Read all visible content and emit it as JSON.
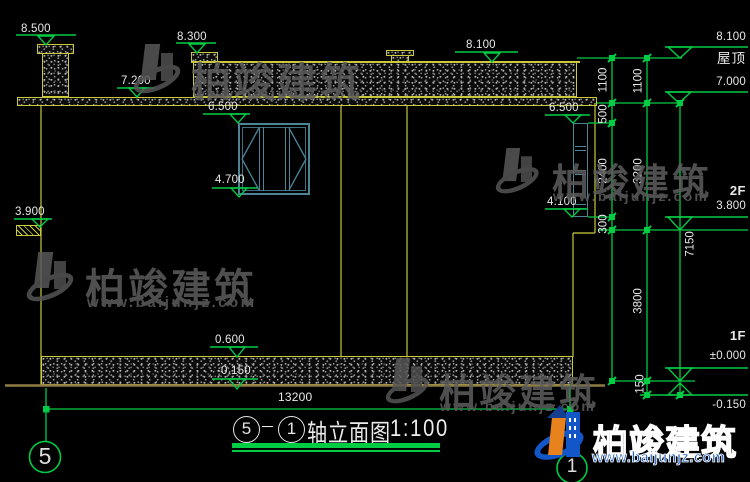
{
  "title_block": {
    "axis_from": "5",
    "axis_to": "1",
    "dash": "－",
    "name": "轴立面图",
    "scale": "1:100"
  },
  "levels": {
    "v8500": "8.500",
    "v8300": "8.300",
    "v8100": "8.100",
    "v7200": "7.200",
    "v7000": "7.000",
    "v6500": "6.500",
    "v4700": "4.700",
    "v4100": "4.100",
    "v3900": "3.900",
    "v3800": "3.800",
    "v0600": "0.600",
    "v0000": "±0.000",
    "vm0150": "-0.150"
  },
  "dimensions": {
    "d1100": "1100",
    "d500": "500",
    "d2400": "2400",
    "d300": "300",
    "d3200": "3200",
    "d3800": "3800",
    "d150": "150",
    "d7150": "7150",
    "total": "13200"
  },
  "floors": {
    "roof": "屋顶",
    "f2": "2F",
    "f1": "1F"
  },
  "axes": {
    "left": "5",
    "right": "1"
  },
  "watermark": {
    "brand": "柏竣建筑",
    "site": "www.baijunjz.com"
  },
  "colors": {
    "line_green": "#00cc44",
    "line_yellow": "#c9c93b",
    "ground_tan": "#8f7c45",
    "window_teal": "#4d8496",
    "text_white": "#e8e8e8",
    "brand_blue": "#1356c8",
    "brand_orange": "#e8821e"
  }
}
